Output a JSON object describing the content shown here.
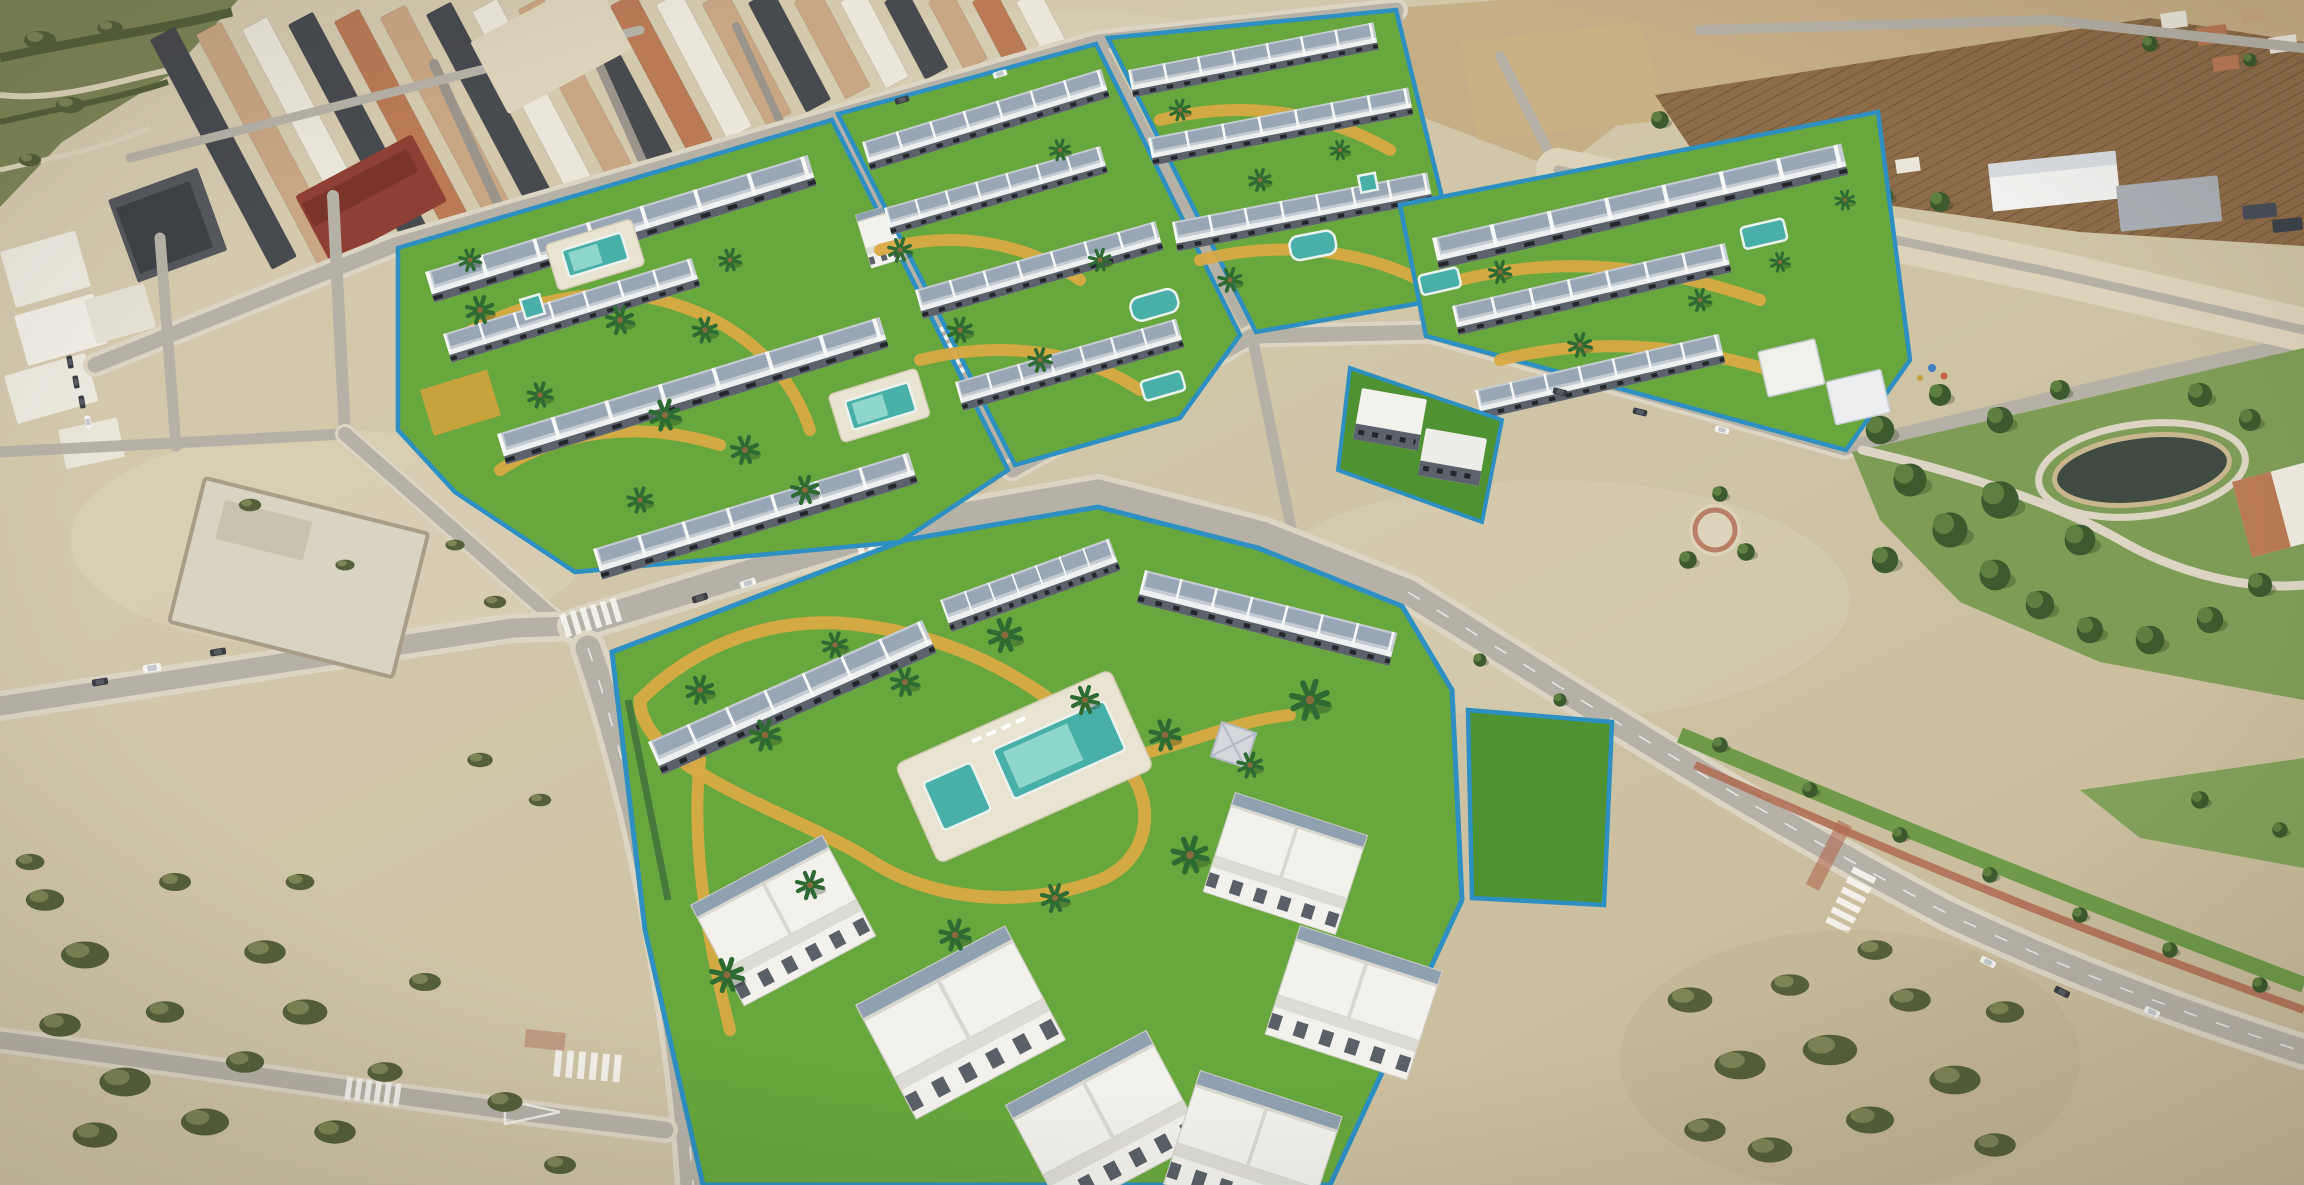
{
  "scene": {
    "type": "aerial-drone-photograph",
    "description": "Aerial drone photo of a Spanish town with rendered new-build residential complexes: white terraced townhouses with grey solar roofs around bright green lawns with yellow paths, turquoise pools and palm trees, enclosed by blue construction fences; surrounded by grey roads with zebra crossings, an old town of terraced rows, sandy vacant lots with scrub, brown plowed fields with warehouses top right, and a pine park with a dark pond on the right.",
    "regions": [
      "old-town",
      "scrubland",
      "farm-fields",
      "warehouse",
      "residential-complex-1",
      "residential-complex-2",
      "residential-complex-3",
      "residential-complex-4",
      "apartment-cubes",
      "main-residential-complex",
      "reserved-lawn-plot",
      "urban-park",
      "pond",
      "boulevard",
      "esplanade",
      "vacant-lots",
      "walled-yard"
    ],
    "objects": {
      "swimming_pools": 9,
      "zebra_crossings": 6,
      "parked_cars": 16,
      "construction_fences": 7,
      "palm_trees": 38
    }
  },
  "palette": {
    "sand": "#cfc4a6",
    "sandLight": "#ddd3ba",
    "sandDark": "#bfb190",
    "scrub": "#7d8456",
    "scrubDark": "#55603a",
    "road": "#b6b1a6",
    "roadLight": "#c9c3b6",
    "sidewalk": "#dcd5c4",
    "asphaltDark": "#9a948a",
    "townDark": "#474a4f",
    "townTan": "#c9a684",
    "townWall": "#ebe6da",
    "brick": "#8e4034",
    "terracotta": "#b97a55",
    "fieldBrown": "#8d6c49",
    "fieldFurrow": "#7a5c3f",
    "fieldTan": "#c3a87e",
    "lawn": "#67a73d",
    "lawnDeep": "#4f9231",
    "pathYellow": "#d9a944",
    "fenceBlue": "#2d8fc2",
    "poolTeal": "#49b0a9",
    "poolLight": "#8fd6cc",
    "white": "#f3f3ee",
    "roofGray": "#c5cbd2",
    "roofPanel": "#8fa0b0",
    "facade": "#5b626b",
    "palm": "#2e6b33",
    "park": "#7f9c57",
    "treeDark": "#3c5a2e",
    "treeLite": "#5d8040",
    "pond": "#3f4b42",
    "shore": "#c8b78e",
    "bikeRed": "#b06a52",
    "grass": "#6f9a4a"
  }
}
